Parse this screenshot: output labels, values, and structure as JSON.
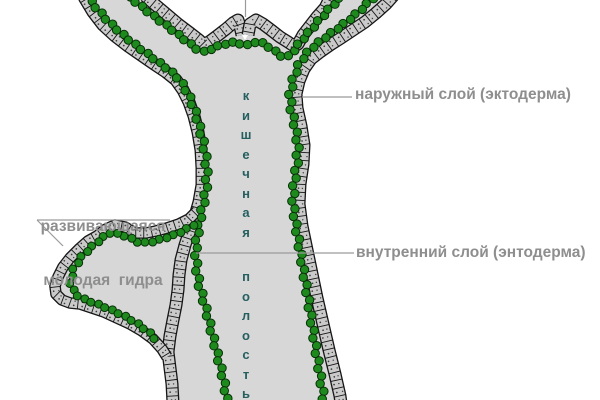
{
  "diagram": {
    "labels": {
      "outer_layer": "наружный слой (эктодерма)",
      "inner_layer": "внутренний слой (энтодерма)",
      "bud_label_line1": "развивающаяся",
      "bud_label_line2": "молодая  гидра",
      "cavity_vertical_word1": "кишечная",
      "cavity_vertical_word2": "полость"
    },
    "colors": {
      "background": "#ffffff",
      "body_fill": "#d7d7d7",
      "ectoderm_cell": "#cacaca",
      "cell_outline": "#161616",
      "endoderm_green": "#1e8a1e",
      "endoderm_outline": "#072f07",
      "label_text": "#8e8e8e",
      "leader_line": "#9a9a9a",
      "cavity_text": "#255f5f"
    }
  }
}
